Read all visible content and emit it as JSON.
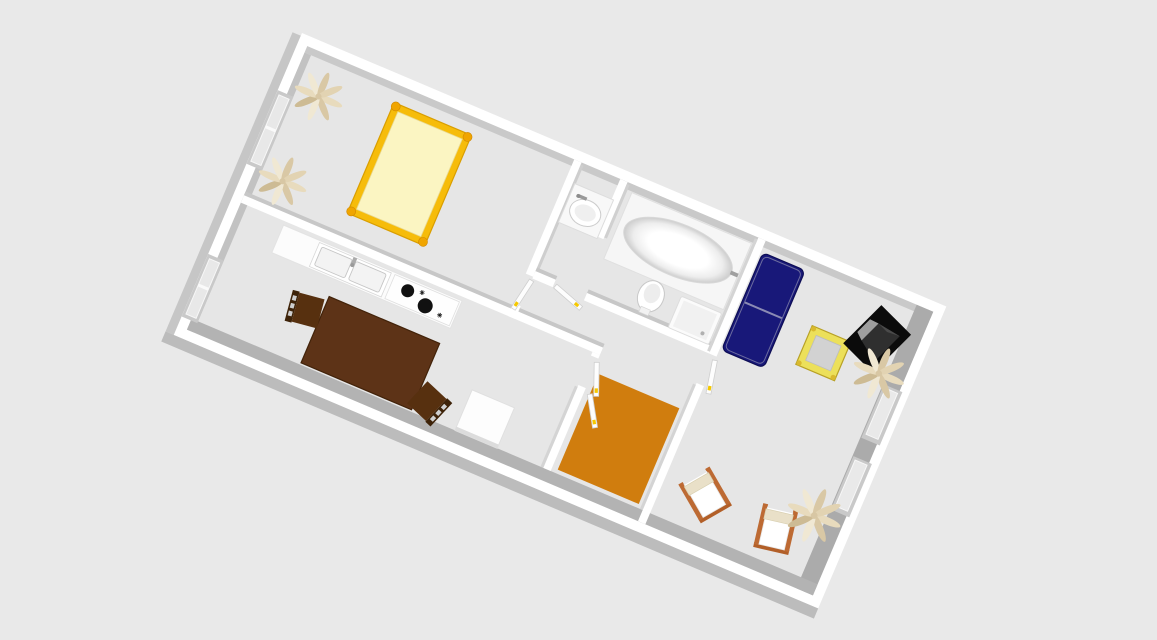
{
  "scene": {
    "view": "3d-overhead-apartment-floor-plan",
    "rooms": [
      "bedroom",
      "bathroom",
      "hallway",
      "kitchen-dining",
      "living-room"
    ],
    "furniture": {
      "bedroom": [
        "double-bed",
        "plant",
        "plant",
        "wall-window"
      ],
      "kitchen_dining": [
        "counter-with-sink",
        "stove-cooktop",
        "dining-table",
        "dining-chair",
        "dining-chair",
        "side-table",
        "wall-window"
      ],
      "bathroom": [
        "washbasin",
        "bathtub",
        "toilet",
        "shower-tray"
      ],
      "hallway": [
        "orange-rug",
        "door",
        "door",
        "door",
        "door",
        "door"
      ],
      "living_room": [
        "sofa",
        "coffee-table",
        "tv-set",
        "lounge-chair",
        "lounge-chair",
        "plant",
        "plant",
        "wall-window",
        "wall-window"
      ]
    }
  },
  "colors": {
    "background": "#e9e9e9",
    "floor": "#e6e6e6",
    "wall": "#ffffff",
    "wall_face_top": "#c9c9c9",
    "wall_face_left": "#c2c2c2",
    "wall_face_right": "#ababab",
    "wall_face_bottom": "#b3b3b3",
    "outer_face": "#bcbcbc",
    "bed_frame": "#f6bc0a",
    "bed_knob": "#f0a500",
    "bed_mattress": "#fbf5c2",
    "rug": "#d07d0e",
    "sofa": "#181879",
    "sofa_piping": "#8b8bb4",
    "coffee_table_frame": "#ece05a",
    "coffee_table_glass": "#d2d2d2",
    "dining_table": "#5d3317",
    "dining_chair": "#4a2810",
    "lounge_frame": "#bd6a33",
    "lounge_fabric": "#ffffff",
    "lounge_cushion": "#e9e0c8",
    "plant_leaf": "#e3d4b4",
    "tv_body": "#2f2f2f",
    "tv_base": "#0b0b0b",
    "tv_screen": "#9e9e9e",
    "door_handle": "#f5c800",
    "stove_burner": "#111111",
    "fixture": "#ffffff"
  }
}
